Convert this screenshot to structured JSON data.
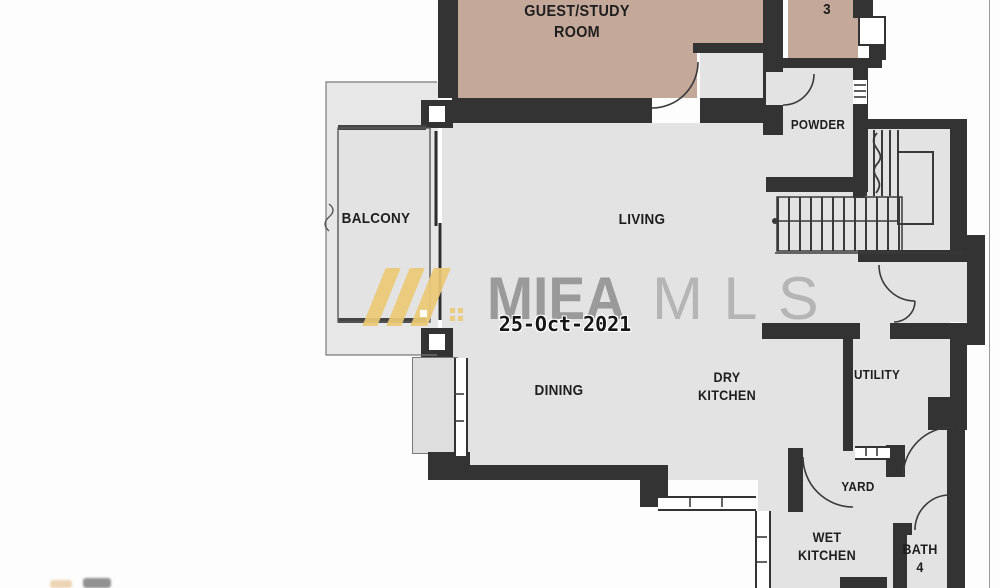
{
  "plan": {
    "rooms": {
      "guest_study": {
        "label": "GUEST/STUDY\nROOM"
      },
      "bath3": {
        "label": "3"
      },
      "powder": {
        "label": "POWDER"
      },
      "balcony": {
        "label": "BALCONY"
      },
      "living": {
        "label": "LIVING"
      },
      "dining": {
        "label": "DINING"
      },
      "dry_kitchen": {
        "label": "DRY\nKITCHEN"
      },
      "utility": {
        "label": "UTILITY"
      },
      "yard": {
        "label": "YARD"
      },
      "wet_kitchen": {
        "label": "WET\nKITCHEN"
      },
      "bath4": {
        "label": "BATH\n4"
      }
    },
    "colors": {
      "wall": "#333333",
      "floor": "#e3e3e3",
      "highlight_room": "#c4a89a",
      "logo_yellow": "#ecc974",
      "brand_bold_gray": "#9a9a9a",
      "brand_light_gray": "#b5b5b5",
      "date_text": "#151515"
    }
  },
  "watermark": {
    "brand_bold": "MIEA",
    "brand_light": "MLS",
    "date": "25-Oct-2021"
  }
}
